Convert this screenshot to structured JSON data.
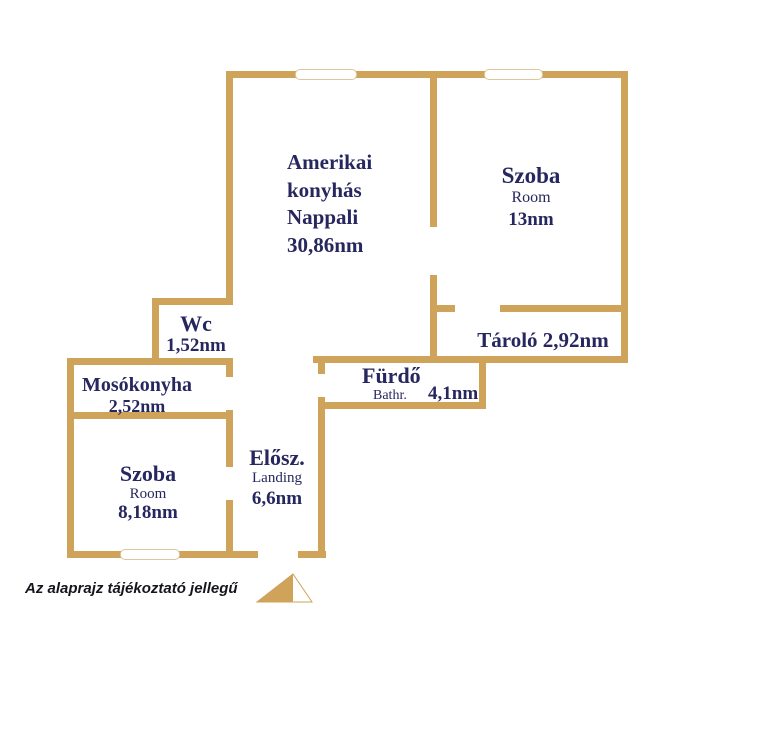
{
  "disclaimer": "Az alaprajz tájékoztató jellegű",
  "colors": {
    "wall": "#cfa35a",
    "window_border": "#dcc79c",
    "room_label": "#27275f",
    "disclaimer_text": "#15151c"
  },
  "rooms": {
    "nappali": {
      "line1": "Amerikai",
      "line2": "konyhás",
      "line3": "Nappali",
      "area": "30,86nm"
    },
    "szoba13": {
      "name": "Szoba",
      "subtitle": "Room",
      "area": "13nm"
    },
    "tarolo": {
      "label": "Tároló 2,92nm"
    },
    "wc": {
      "name": "Wc",
      "area": "1,52nm"
    },
    "mosokonyha": {
      "name": "Mosókonyha",
      "area": "2,52nm"
    },
    "szoba8": {
      "name": "Szoba",
      "subtitle": "Room",
      "area": "8,18nm"
    },
    "elosz": {
      "name": "Elősz.",
      "subtitle": "Landing",
      "area": "6,6nm"
    },
    "furdo": {
      "name": "Fürdő",
      "subtitle": "Bathr.",
      "area": "4,1nm"
    }
  }
}
